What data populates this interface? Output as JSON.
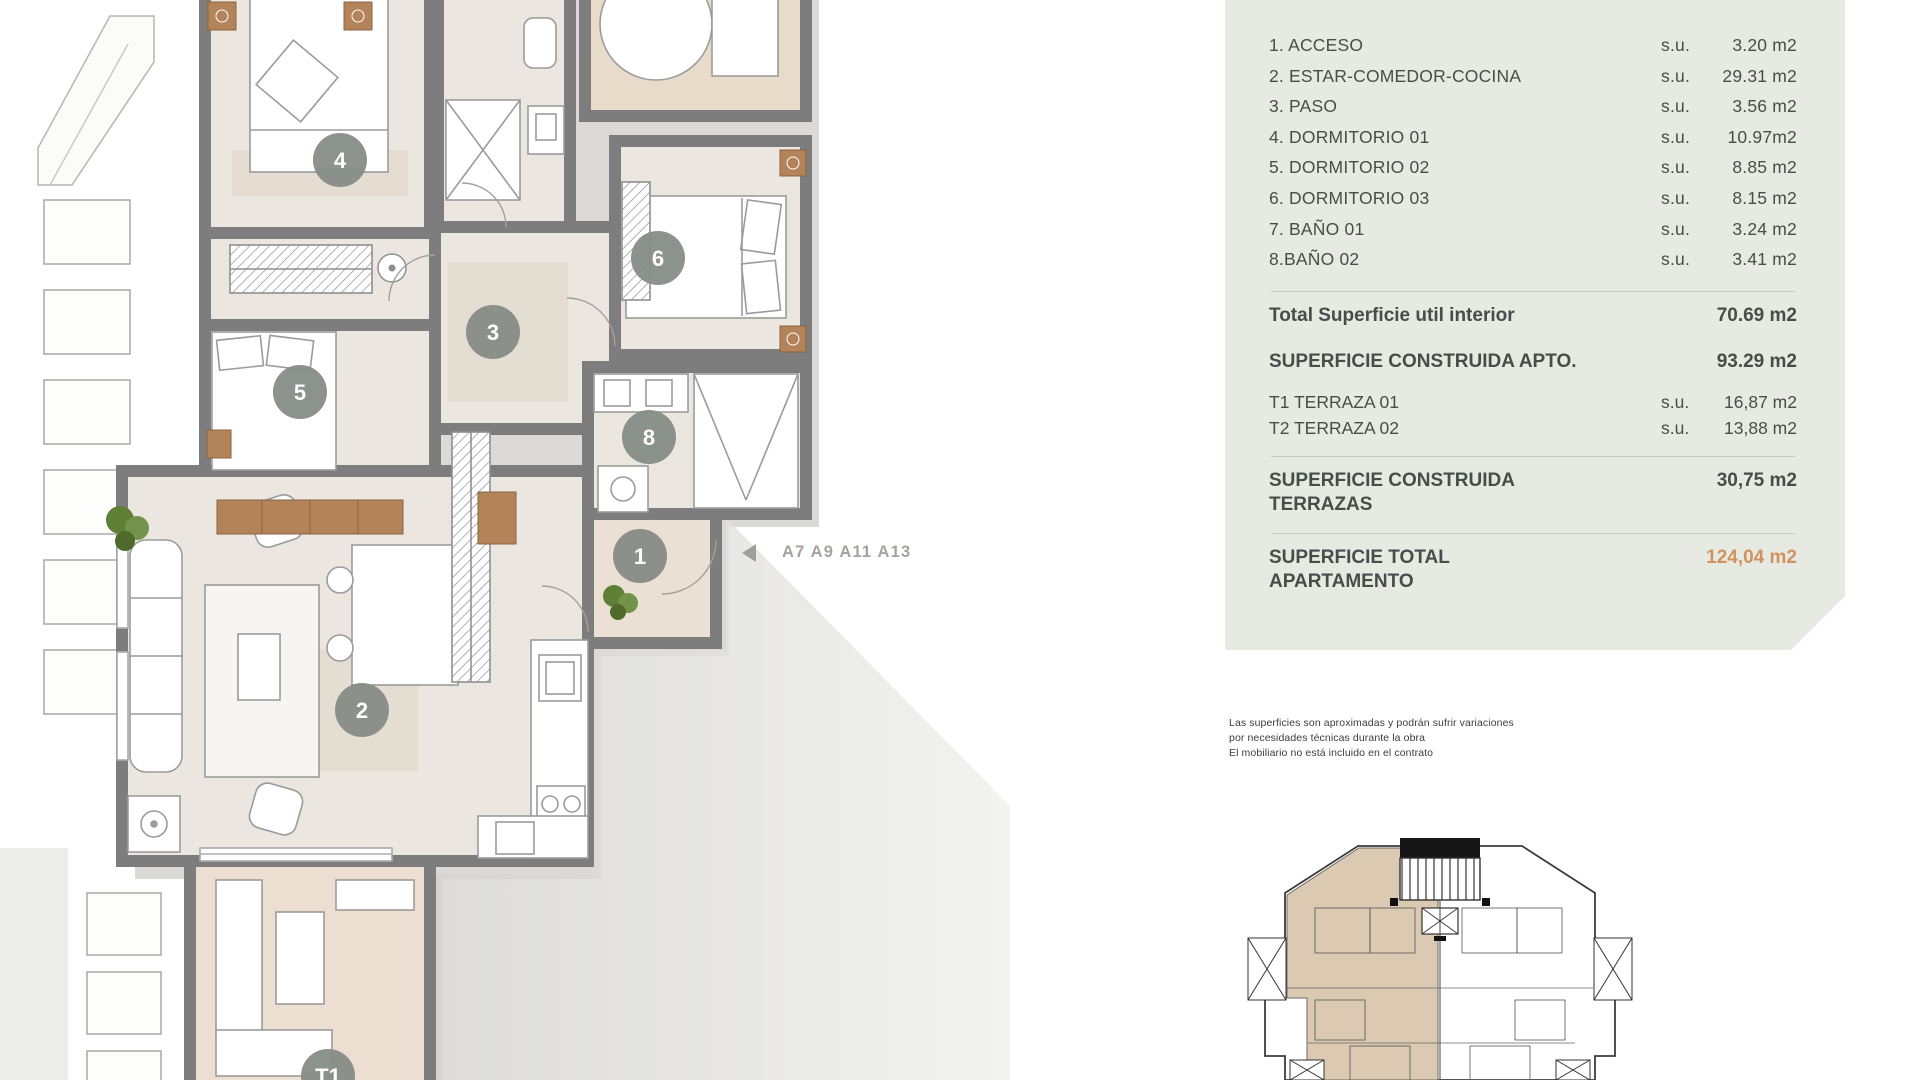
{
  "legend": {
    "rooms": [
      {
        "label": "1. ACCESO",
        "unit": "s.u.",
        "value": "3.20 m2"
      },
      {
        "label": "2. ESTAR-COMEDOR-COCINA",
        "unit": "s.u.",
        "value": "29.31 m2"
      },
      {
        "label": "3. PASO",
        "unit": "s.u.",
        "value": "3.56 m2"
      },
      {
        "label": "4. DORMITORIO 01",
        "unit": "s.u.",
        "value": "10.97m2"
      },
      {
        "label": "5. DORMITORIO 02",
        "unit": "s.u.",
        "value": "8.85 m2"
      },
      {
        "label": "6. DORMITORIO 03",
        "unit": "s.u.",
        "value": "8.15 m2"
      },
      {
        "label": "7. BAÑO 01",
        "unit": "s.u.",
        "value": "3.24 m2"
      },
      {
        "label": "8.BAÑO 02",
        "unit": "s.u.",
        "value": "3.41 m2"
      }
    ],
    "totals": {
      "interior_label": "Total Superficie util interior",
      "interior_value": "70.69 m2",
      "construida_apto_label": "SUPERFICIE CONSTRUIDA APTO.",
      "construida_apto_value": "93.29 m2",
      "terraza1_label": "T1 TERRAZA 01",
      "terraza1_unit": "s.u.",
      "terraza1_value": "16,87 m2",
      "terraza2_label": "T2 TERRAZA 02",
      "terraza2_unit": "s.u.",
      "terraza2_value": "13,88 m2",
      "construida_terrazas_label1": "SUPERFICIE CONSTRUIDA",
      "construida_terrazas_label2": "TERRAZAS",
      "construida_terrazas_value": "30,75 m2",
      "total_apartamento_label1": "SUPERFICIE TOTAL",
      "total_apartamento_label2": "APARTAMENTO",
      "total_apartamento_value": "124,04 m2"
    }
  },
  "plan": {
    "unit_label": "A7 A9 A11 A13",
    "markers": {
      "m1": "1",
      "m2": "2",
      "m3": "3",
      "m4": "4",
      "m5": "5",
      "m6": "6",
      "m8": "8",
      "t1": "T1"
    }
  },
  "disclaimer": {
    "line1": "Las superficies son aproximadas y podrán sufrir variaciones",
    "line2": "por necesidades técnicas durante la obra",
    "line3": "El mobiliario no está incluido en el contrato"
  },
  "colors": {
    "panel_bg": "#e7eae3",
    "wall_gray": "#7d7d7d",
    "floor_beige": "#ebe6df",
    "terrace_tan": "#e8dbc9",
    "marker_fill": "#868c86",
    "wood": "#b3835a",
    "accent_orange": "#d2925e",
    "highlight_keyplan": "#dbc9b2"
  }
}
